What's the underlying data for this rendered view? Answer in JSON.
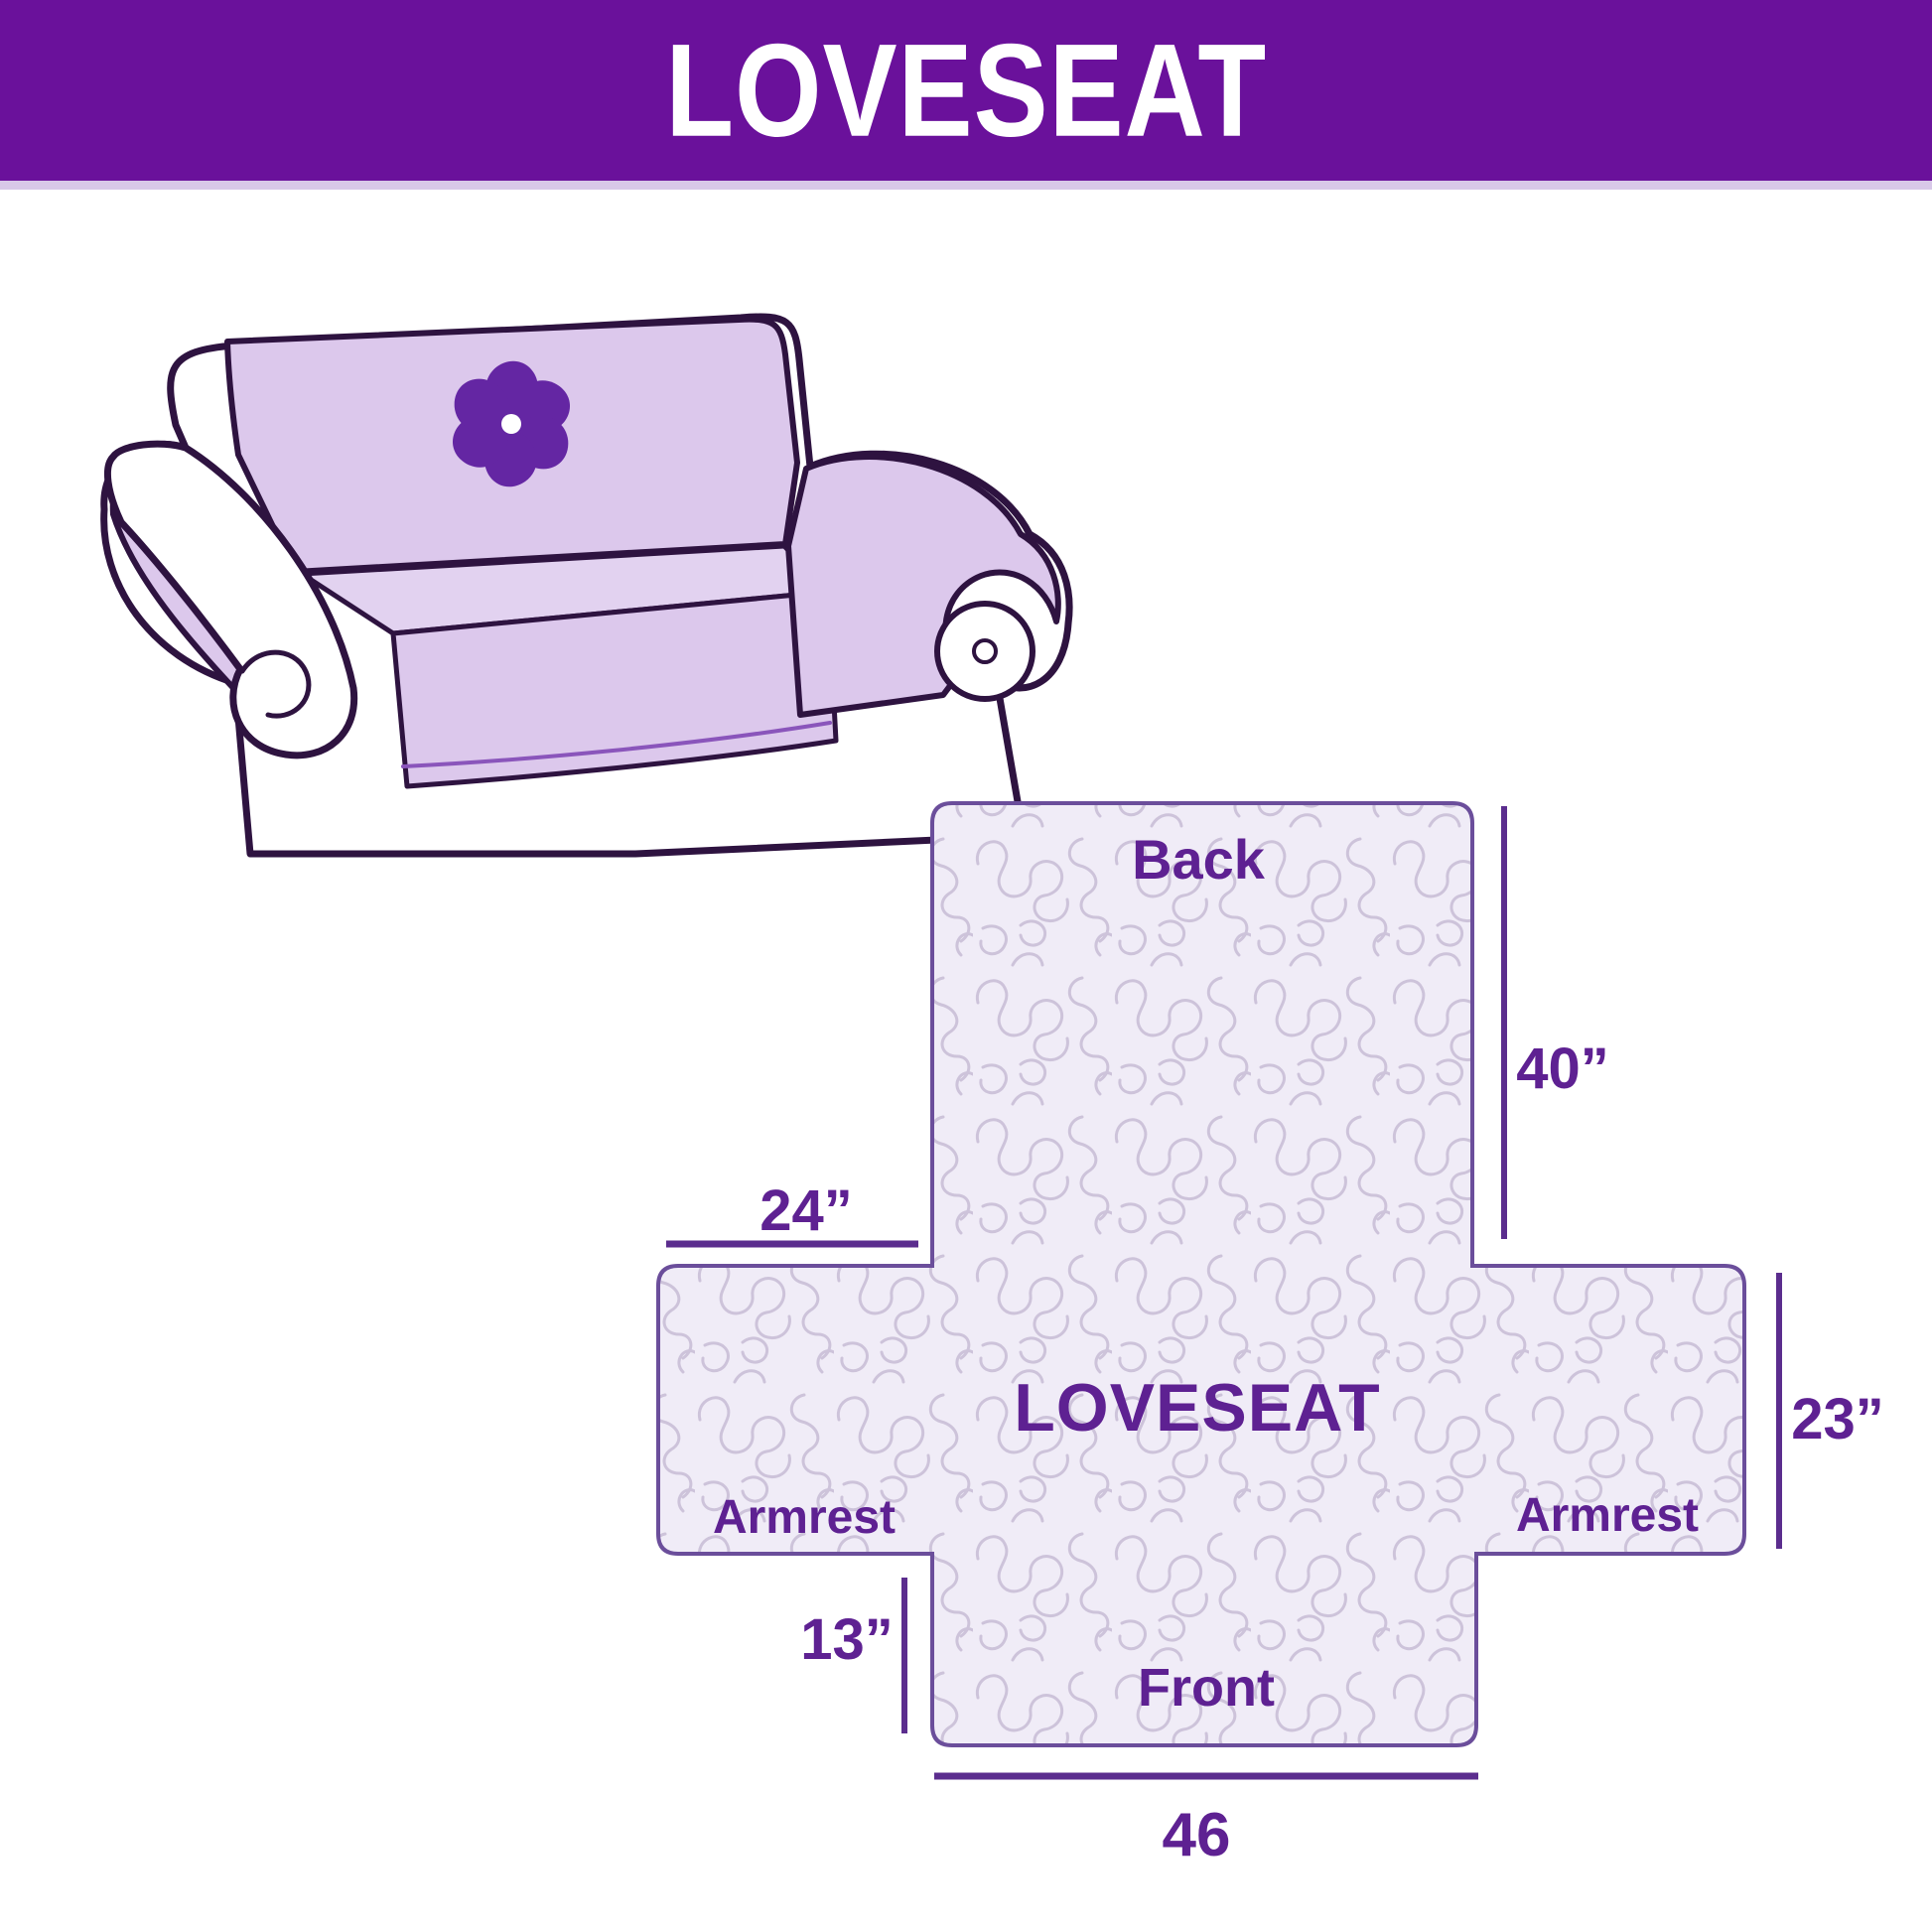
{
  "header": {
    "title": "LOVESEAT",
    "background_color": "#6a119b",
    "text_color": "#ffffff"
  },
  "illustration": {
    "subject": "loveseat sofa with quilted slipcover",
    "cover_color": "#dcc8ec",
    "outline_color": "#2e1340",
    "logo_icon": "pinwheel-flower-icon",
    "logo_color": "#6426a3"
  },
  "diagram": {
    "center_label": "LOVESEAT",
    "sections": {
      "back": "Back",
      "front": "Front",
      "armrest_left": "Armrest",
      "armrest_right": "Armrest"
    },
    "dimensions": {
      "back_height": "40”",
      "armrest_top_width": "24”",
      "side_depth": "23”",
      "front_drop": "13”",
      "front_width": "46"
    },
    "fabric_color": "#f0ecf7",
    "pattern_color": "#cdc3da",
    "outline_color": "#6b4e9b",
    "dimension_line_color": "#5b2d8e",
    "label_color": "#5e2192"
  }
}
